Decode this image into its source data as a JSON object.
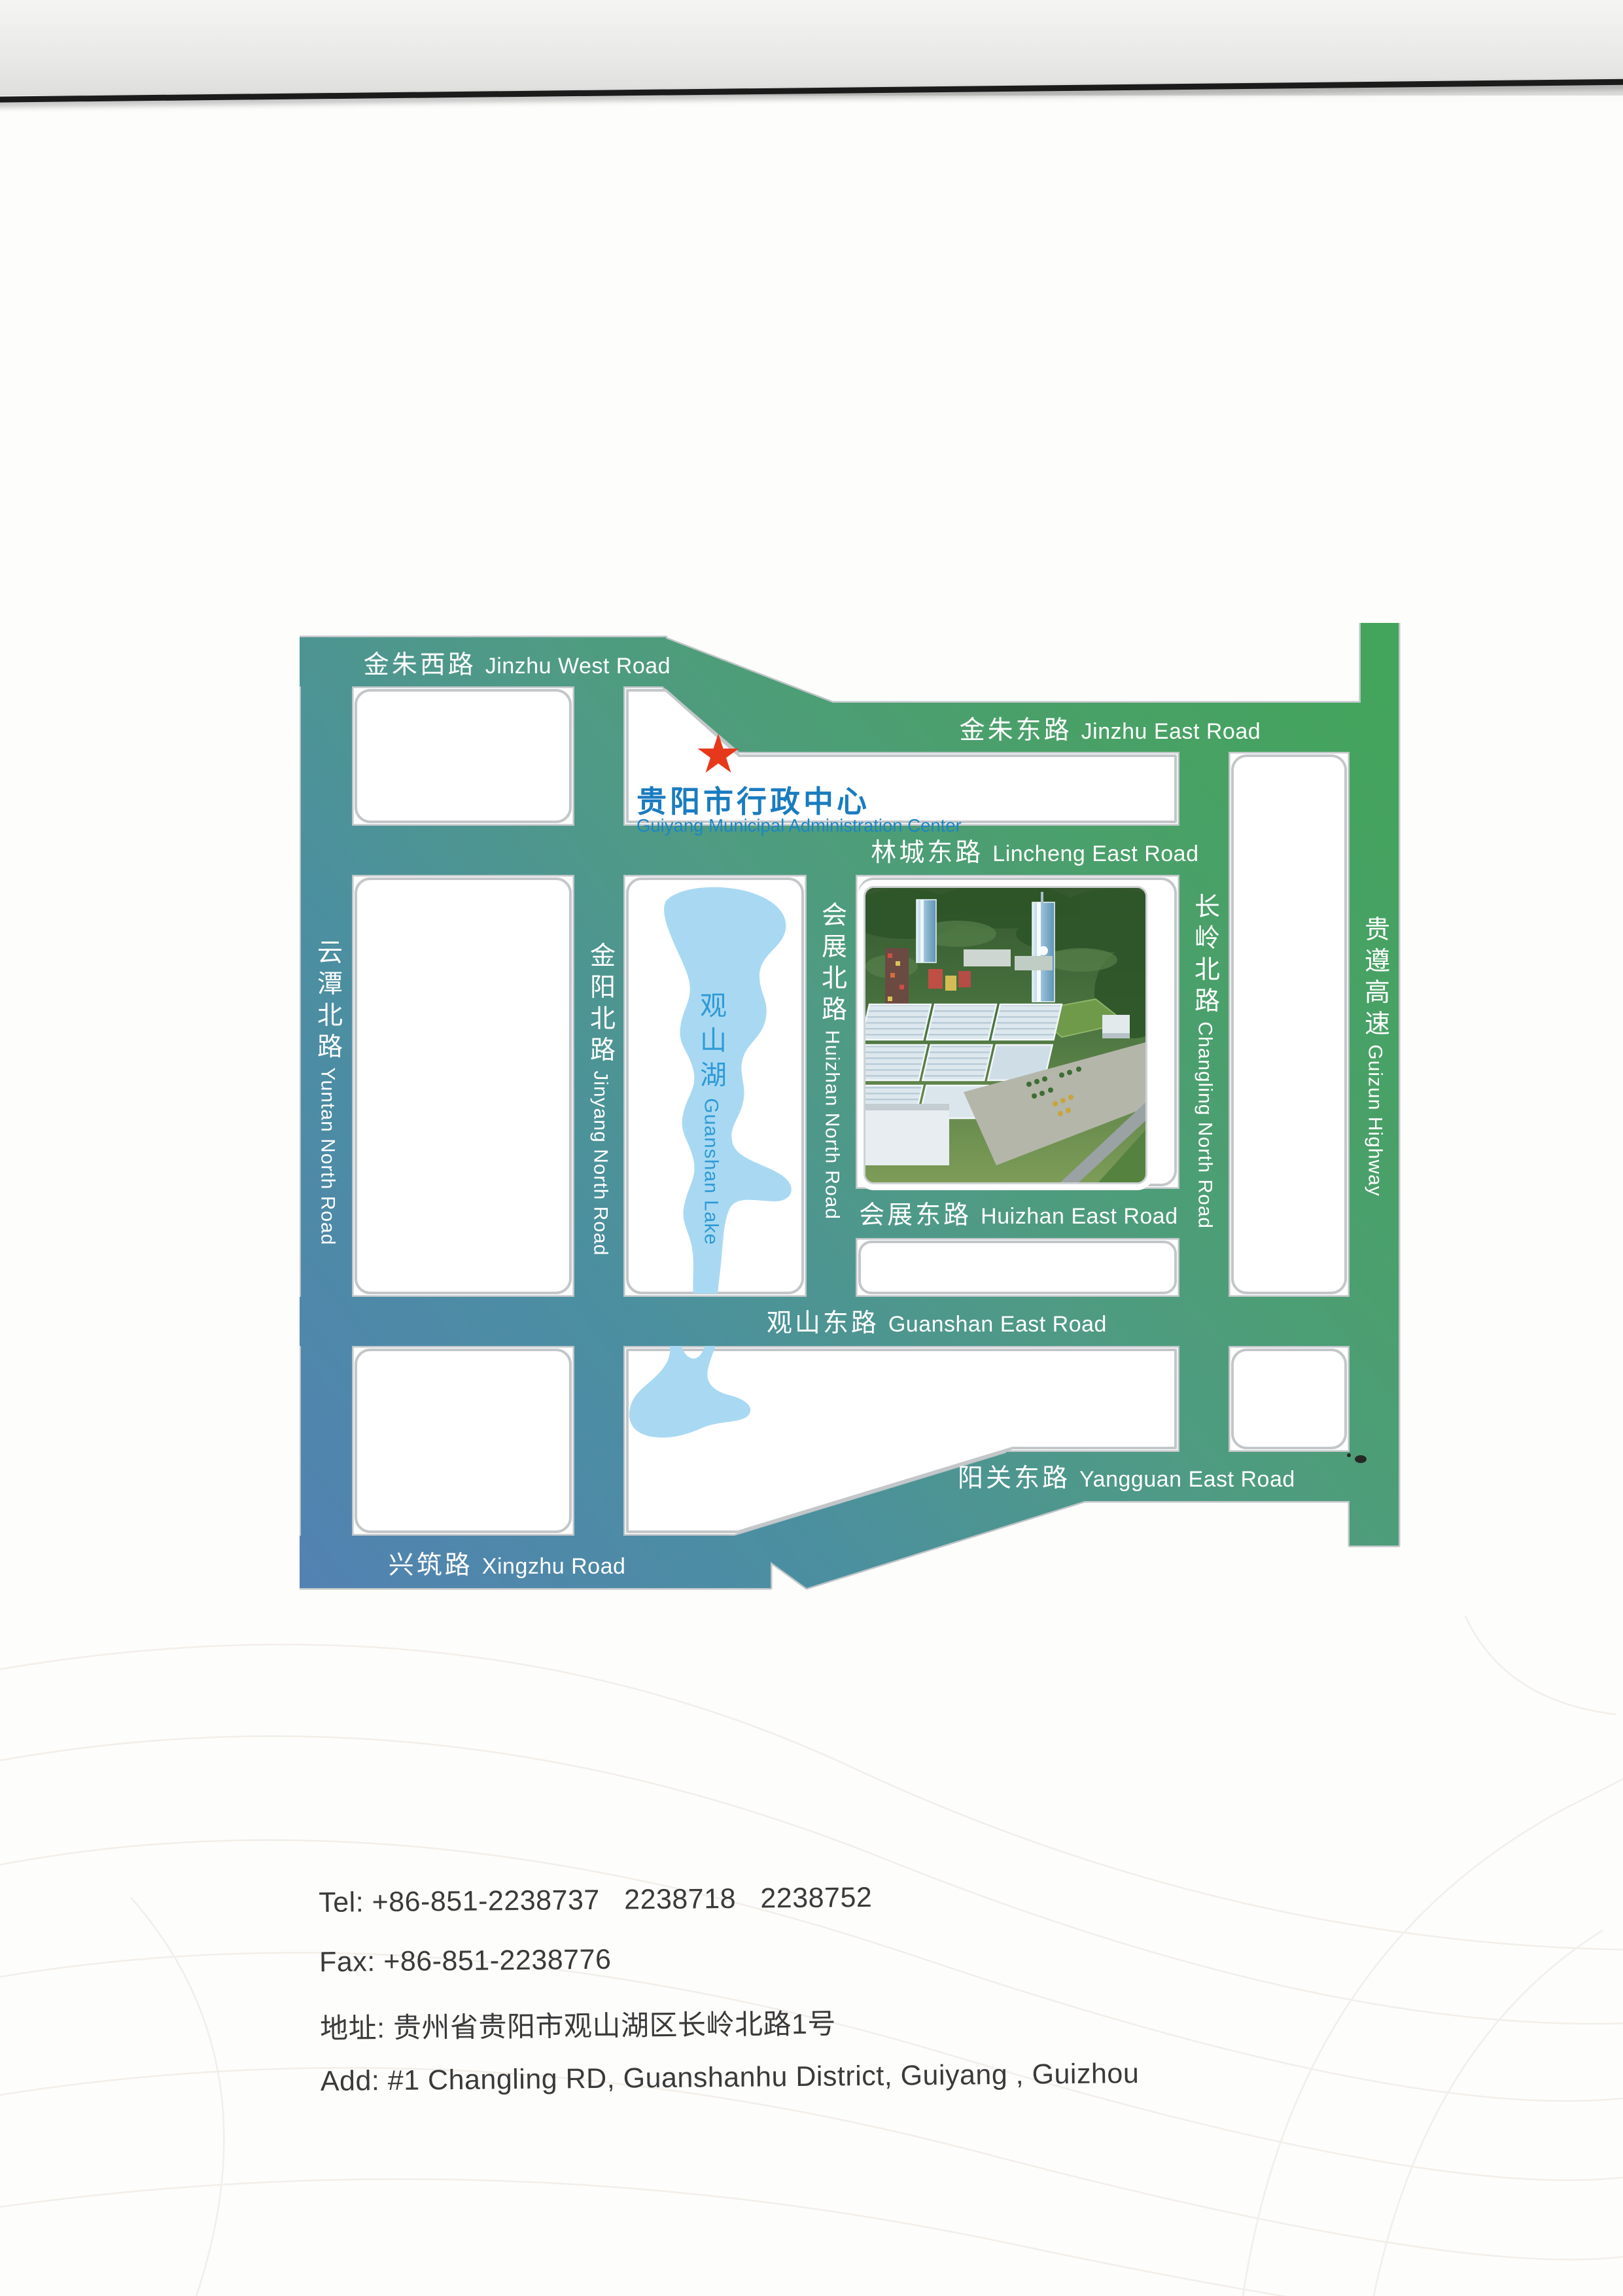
{
  "map": {
    "marker": {
      "star_glyph": "★",
      "zh": "贵阳市行政中心",
      "en": "Guiyang Municipal Administration Center"
    },
    "lake": {
      "zh": "观山湖",
      "en": "Guanshan Lake"
    },
    "roads": {
      "jinzhu_west": {
        "zh": "金朱西路",
        "en": "Jinzhu West Road"
      },
      "jinzhu_east": {
        "zh": "金朱东路",
        "en": "Jinzhu East Road"
      },
      "lincheng_east": {
        "zh": "林城东路",
        "en": "Lincheng East Road"
      },
      "huizhan_east": {
        "zh": "会展东路",
        "en": "Huizhan East Road"
      },
      "guanshan_east": {
        "zh": "观山东路",
        "en": "Guanshan East Road"
      },
      "yangguan_east": {
        "zh": "阳关东路",
        "en": "Yangguan East Road"
      },
      "xingzhu": {
        "zh": "兴筑路",
        "en": "Xingzhu Road"
      },
      "yuntan_north": {
        "zh": "云潭北路",
        "en": "Yuntan North Road"
      },
      "jinyang_north": {
        "zh": "金阳北路",
        "en": "Jinyang North Road"
      },
      "huizhan_north": {
        "zh": "会展北路",
        "en": "Huizhan North Road"
      },
      "changling_north": {
        "zh": "长岭北路",
        "en": "Changling North Road"
      },
      "guizun_highway": {
        "zh": "贵遵高速",
        "en": "Guizun Highway"
      }
    },
    "colors": {
      "road_blue": "#5282b2",
      "road_teal": "#4b8fa0",
      "road_green": "#43a45c",
      "lake_fill": "#a9d9f2",
      "lake_text": "#2f9ad6",
      "marker_text": "#1a7cc0",
      "star_red": "#e6391b",
      "block_border": "#c3c7ca"
    }
  },
  "contact": {
    "tel_label": "Tel:",
    "tel_value": "+86-851-2238737   2238718   2238752",
    "fax_label": "Fax:",
    "fax_value": "+86-851-2238776",
    "addr_label": "地址:",
    "addr_value": "贵州省贵阳市观山湖区长岭北路1号",
    "addr_en_label": "Add:",
    "addr_en_value": "#1 Changling RD, Guanshanhu District, Guiyang , Guizhou"
  }
}
